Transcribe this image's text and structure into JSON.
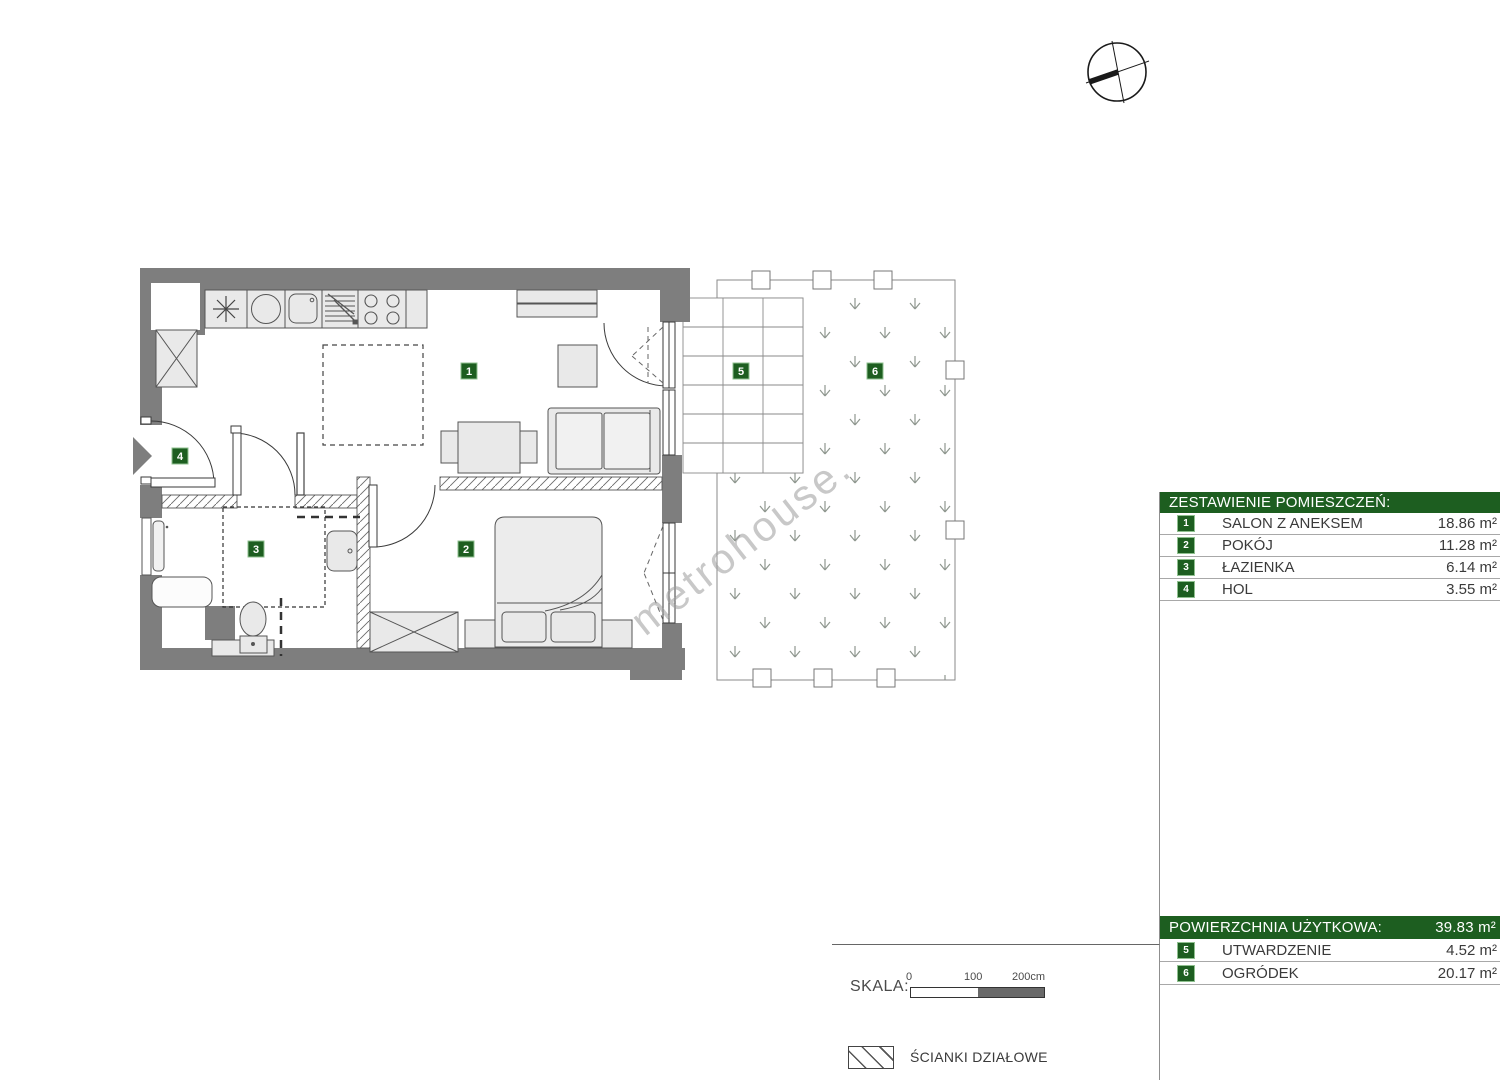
{
  "watermark_text": "metrohouse.",
  "plan": {
    "room_labels": {
      "r1": "1",
      "r2": "2",
      "r3": "3",
      "r4": "4",
      "r5": "5",
      "r6": "6"
    }
  },
  "rooms_table": {
    "title": "ZESTAWIENIE POMIESZCZEŃ:",
    "rows": [
      {
        "num": "1",
        "label": "SALON Z ANEKSEM",
        "area": "18.86 m²"
      },
      {
        "num": "2",
        "label": "POKÓJ",
        "area": "11.28 m²"
      },
      {
        "num": "3",
        "label": "ŁAZIENKA",
        "area": "6.14 m²"
      },
      {
        "num": "4",
        "label": "HOL",
        "area": "3.55 m²"
      }
    ]
  },
  "summary_table": {
    "title": "POWIERZCHNIA UŻYTKOWA:",
    "total_area": "39.83 m²",
    "rows": [
      {
        "num": "5",
        "label": "UTWARDZENIE",
        "area": "4.52 m²"
      },
      {
        "num": "6",
        "label": "OGRÓDEK",
        "area": "20.17 m²"
      }
    ]
  },
  "scale_legend": {
    "label": "SKALA:",
    "tick0": "0",
    "tick100": "100",
    "tick200": "200cm"
  },
  "walls_legend": {
    "label": "ŚCIANKI DZIAŁOWE"
  },
  "colors": {
    "green": "#1d5e20",
    "wall_gray": "#7e7e7e",
    "furniture_fill": "#e9e9e9"
  }
}
